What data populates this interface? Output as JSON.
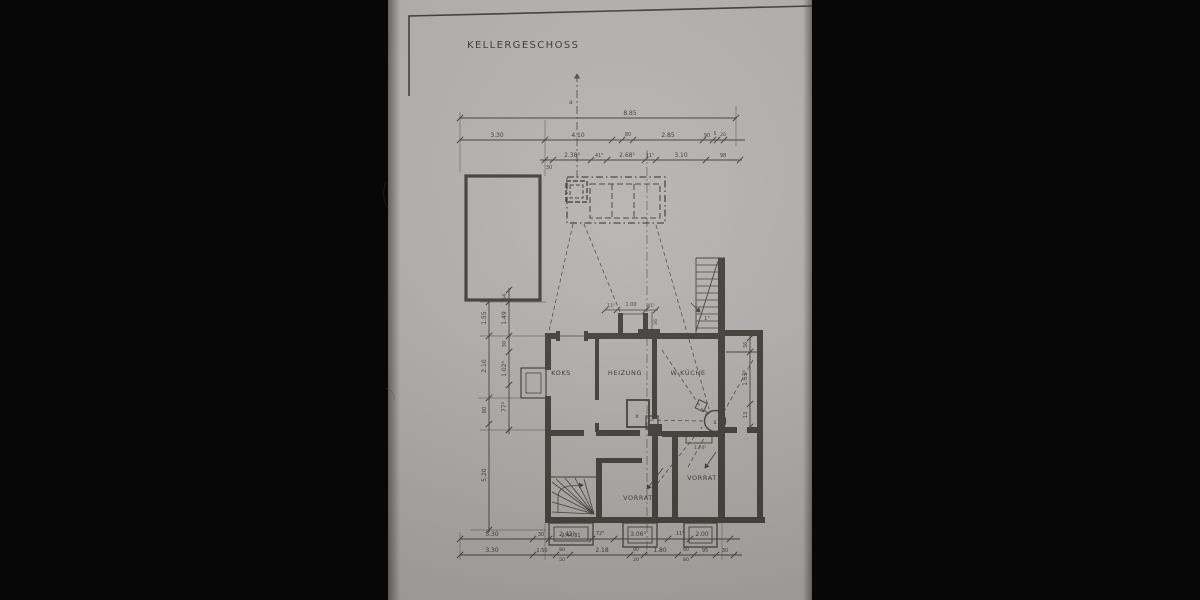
{
  "title": "KELLERGESCHOSS",
  "rooms": {
    "koks": "KOKS",
    "heizung": "HEIZUNG",
    "wkueche": "W-KÜCHE",
    "vorrat_a": "VORRAT",
    "vorrat_b": "VORRAT"
  },
  "symbols": {
    "boiler": "x",
    "chimney": "s"
  },
  "dimensions": {
    "top_total": "8.85",
    "top_row2": [
      "3.30",
      "4.10",
      "80",
      "2.85",
      "90",
      "5",
      "20"
    ],
    "top_row3": [
      "30",
      "2.38⁵",
      "41⁵",
      "2.68⁵",
      "11⁵",
      "3.10",
      "98"
    ],
    "opening_top": [
      "11⁵",
      "1.00",
      "41⁵",
      "36"
    ],
    "left_outer": [
      "1.55",
      "2.10",
      "80",
      "5.20"
    ],
    "left_inner": [
      "64",
      "1.49",
      "30",
      "1.02⁵",
      "77⁵"
    ],
    "right_side": [
      "36",
      "1.63⁵",
      "13"
    ],
    "bottom_row1": [
      "3.30",
      "30",
      "2.42⁵",
      "72⁵",
      "3.06⁵",
      "11⁵",
      "2.00"
    ],
    "bottom_row2": [
      "3.30",
      "1.50",
      "2.18",
      "1.80",
      "95",
      "30"
    ],
    "bottom_row2_pairs": [
      {
        "top": "80",
        "bottom": "50"
      },
      {
        "top": "80",
        "bottom": "20"
      },
      {
        "top": "60",
        "bottom": "80"
      }
    ],
    "window_stair": "2.44/81",
    "window_pantry": "1.74⁵",
    "door_note": "1°",
    "section_mark": "a"
  }
}
